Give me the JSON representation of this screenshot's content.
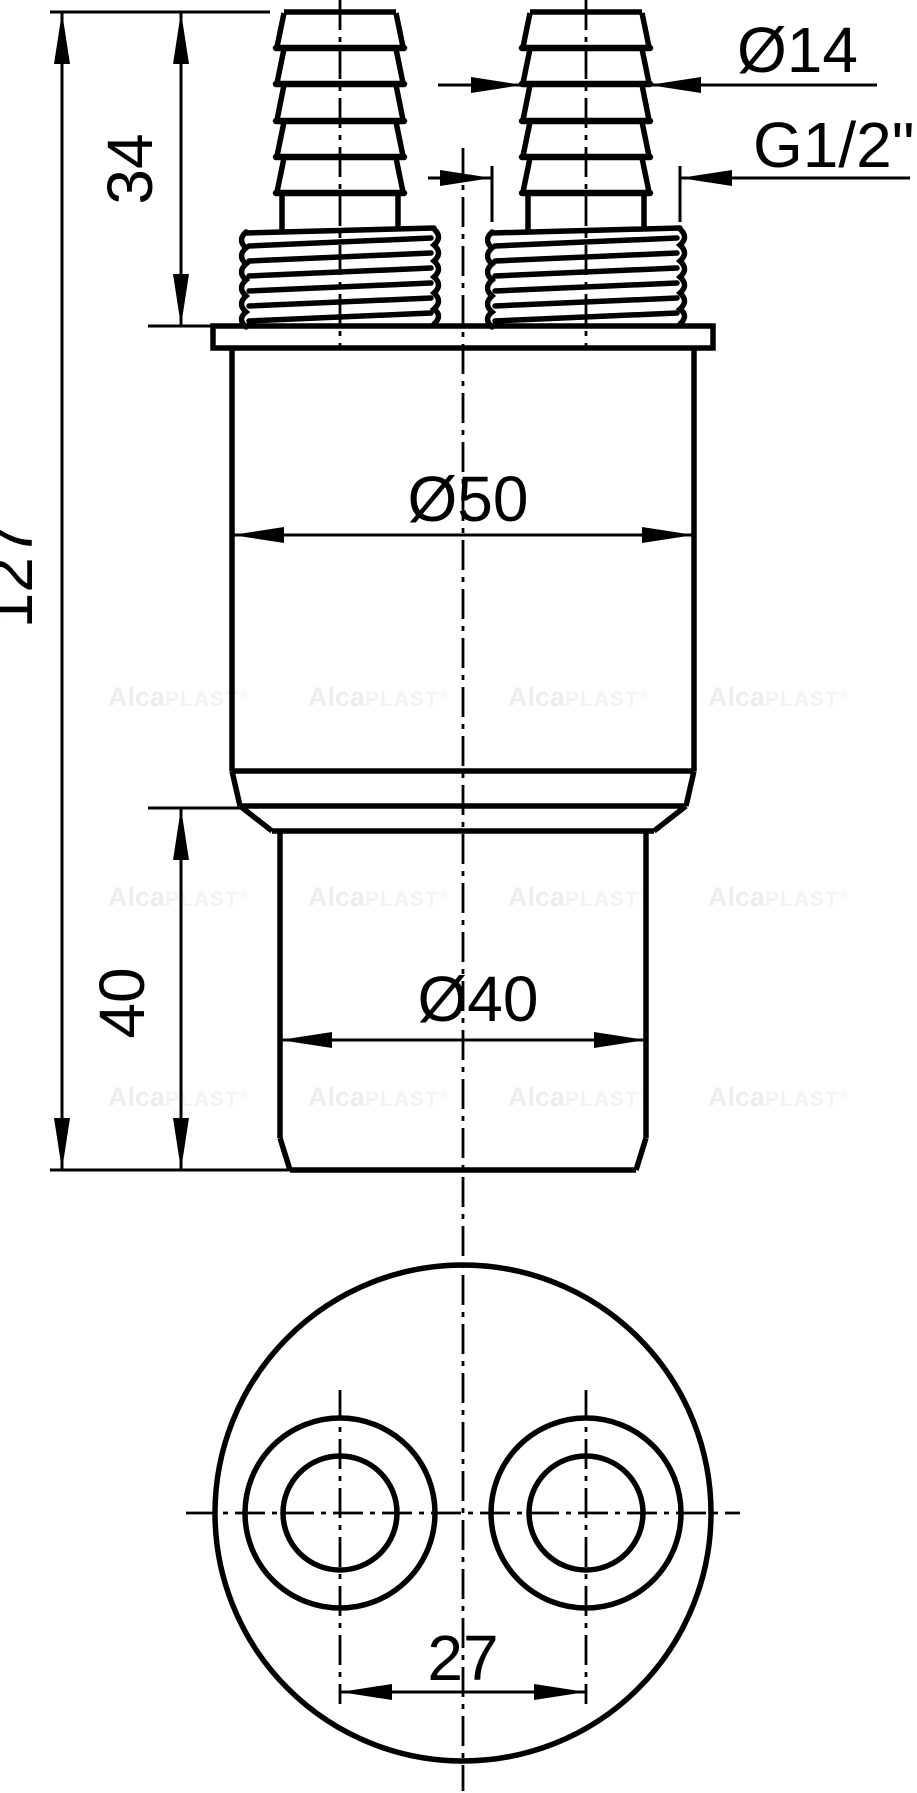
{
  "drawing": {
    "labels": {
      "barb_diameter": "Ø14",
      "thread_size": "G1/2\"",
      "connector_height": "34",
      "overall_height": "127",
      "body_diameter": "Ø50",
      "outlet_height": "40",
      "outlet_diameter": "Ø40",
      "port_spacing": "27"
    },
    "watermark": {
      "bold": "Alca",
      "light": "PLAST",
      "reg": "®"
    },
    "colors": {
      "line": "#000000",
      "background": "#ffffff",
      "watermark_bold": "#ededed",
      "watermark_light": "#f3f3f3"
    }
  }
}
